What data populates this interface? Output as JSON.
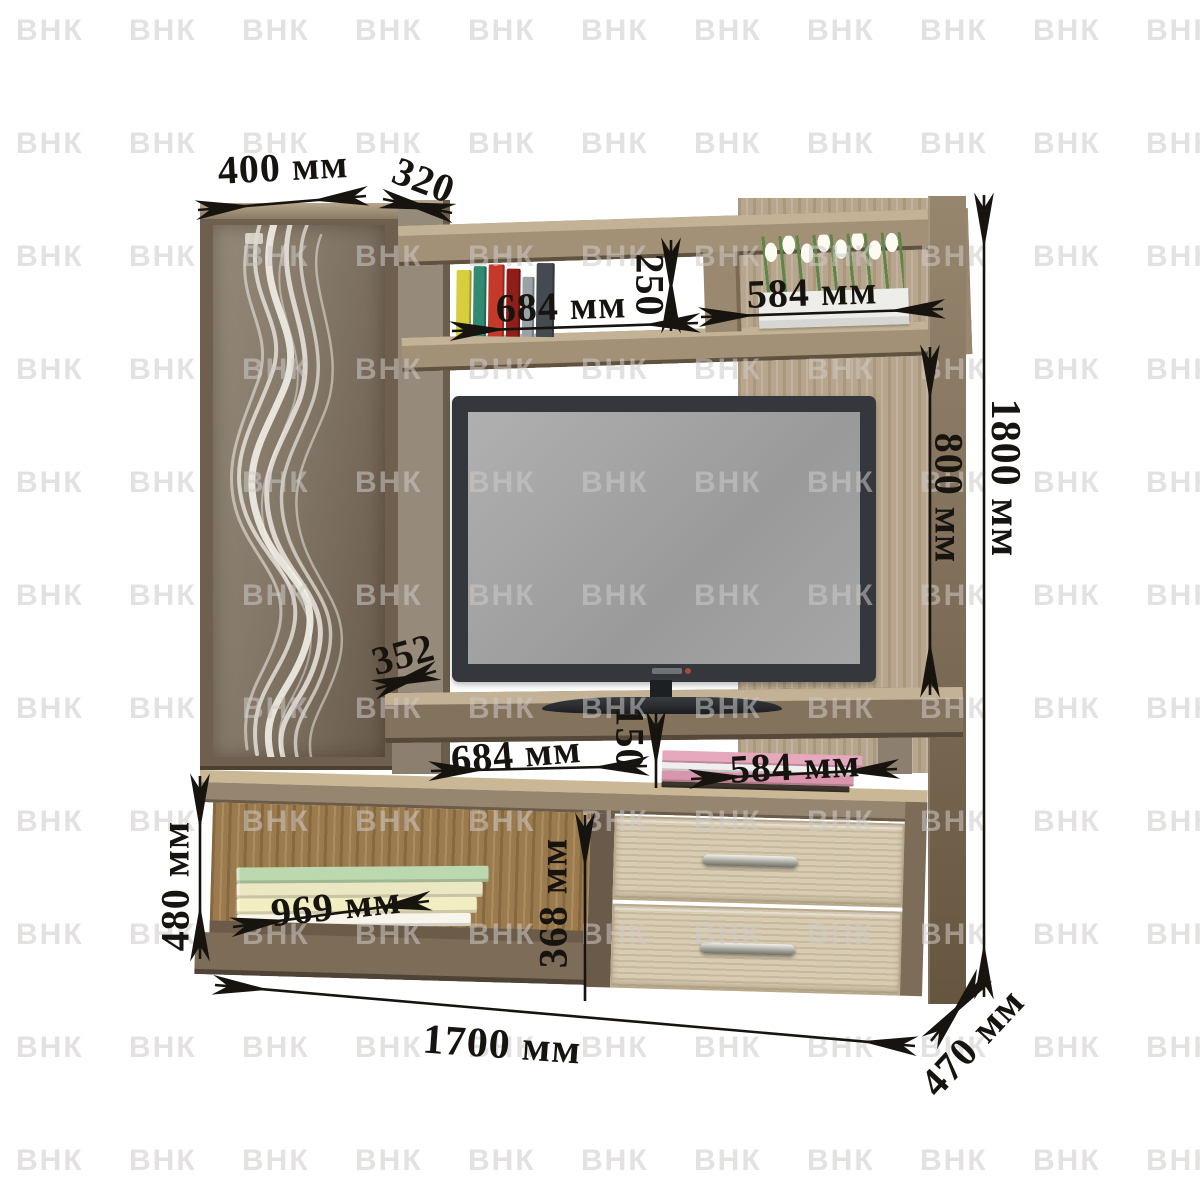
{
  "watermark": {
    "text": "ВНК"
  },
  "dimensions": {
    "cabinet_width": "400 мм",
    "cabinet_top_depth": "320",
    "upper_shelf_width": "684 мм",
    "upper_shelf_height": "250",
    "upper_niche_width": "584 мм",
    "tv_niche_height": "800 мм",
    "total_height": "1800 мм",
    "tv_shelf_depth": "352",
    "tv_shelf_width": "684 мм",
    "tv_shelf_gap_height": "150",
    "base_niche_width": "584 мм",
    "base_shelf_width": "969 мм",
    "base_height": "480 мм",
    "base_inner_height": "368 мм",
    "total_width": "1700 мм",
    "total_depth": "470 мм"
  },
  "palette": {
    "wood_dark": "#6e5f4e",
    "wood_medium": "#8f7e67",
    "wood_light": "#c9b795",
    "wood_panel": "#b7a68d",
    "glass": "#837767",
    "annotation": "#17140f",
    "tv_bezel": "#34373b",
    "tv_screen": "#a4a4a4"
  },
  "decor": {
    "top_book_spines": [
      "#d6ce3c",
      "#2f8a71",
      "#c5392b",
      "#8f1d18",
      "#9aa2a8",
      "#454a50"
    ],
    "stacked_books": [
      "#bcd8ae",
      "#ece7c3",
      "#f2eec2",
      "#f7f5ec"
    ],
    "pink_books": [
      "#e5a8bd",
      "#f0eff0",
      "#d995ac",
      "#3c352c"
    ],
    "tulip_bloom": "#fbfbf2",
    "tulip_stem": "#5d8746"
  }
}
